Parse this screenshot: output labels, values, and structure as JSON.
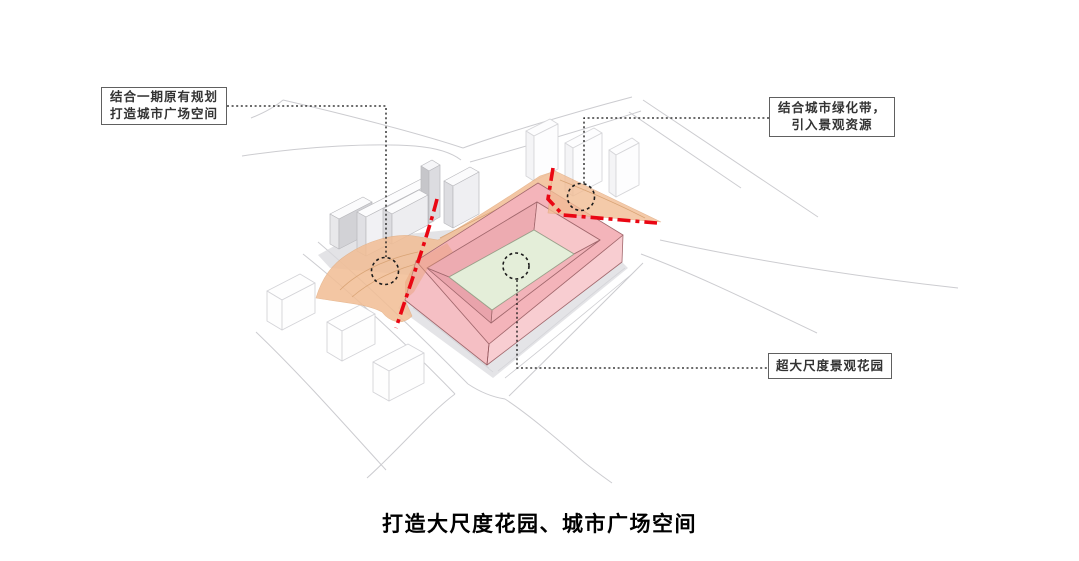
{
  "title": "打造大尺度花园、城市广场空间",
  "annotations": {
    "top_left": {
      "line1": "结合一期原有规划",
      "line2": "打造城市广场空间"
    },
    "top_right": {
      "line1": "结合城市绿化带，",
      "line2": "引入景观资源"
    },
    "right": {
      "text": "超大尺度景观花园"
    }
  },
  "colors": {
    "pink_roof": "#f4b4ba",
    "pink_wall_sw": "#f5bfc4",
    "pink_wall_se": "#f8cdd1",
    "pink_inner_nw": "#edabb1",
    "pink_inner_ne": "#f7c6c9",
    "pink_inner_se": "#f2b3b9",
    "pink_inner_sw": "#e9a3ab",
    "courtyard_green": "#e4eed9",
    "plaza_orange": "#f2bd94",
    "plaza_overlap": "#e89f78",
    "axis_red": "#ea0613",
    "road_gray": "#ccccd0",
    "shadow_gray": "#d9d9dd",
    "building_edge": "#a2686d",
    "leader_black": "#141414"
  }
}
